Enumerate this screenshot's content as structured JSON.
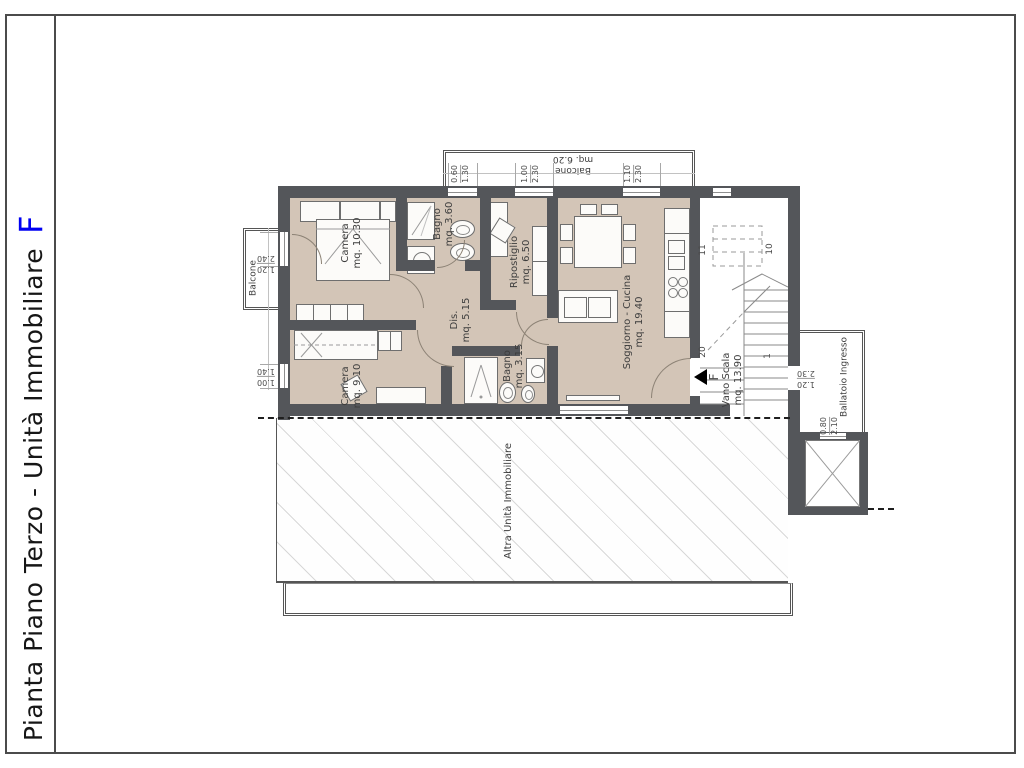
{
  "page": {
    "title_main": "Pianta Piano Terzo - Unità Immobiliare",
    "title_unit": "F"
  },
  "rooms": {
    "camera1": {
      "name": "Camera",
      "area": "mq. 10.30"
    },
    "bagno1": {
      "name": "Bagno",
      "area": "mq. 3.60"
    },
    "ripostiglio": {
      "name": "Ripostiglio",
      "area": "mq. 6.50"
    },
    "soggiorno": {
      "name": "Soggiorno - Cucina",
      "area": "mq. 19.40"
    },
    "dis": {
      "name": "Dis.",
      "area": "mq. 5.15"
    },
    "camera2": {
      "name": "Camera",
      "area": "mq. 9.10"
    },
    "bagno2": {
      "name": "Bagno",
      "area": "mq. 3.15"
    },
    "vano_scala": {
      "name": "Vano Scala",
      "area": "mq. 13.90"
    }
  },
  "outdoor": {
    "balcone_left": "Balcone",
    "balcone_top": {
      "name": "Balcone",
      "area": "mq. 6.20"
    },
    "ballatoio": "Ballatoio Ingresso",
    "altra_unita": "Altra Unità Immobiliare"
  },
  "entrance_marker": "F",
  "stairs": {
    "n_1": "1",
    "n_10": "10",
    "n_11": "11",
    "n_20": "20"
  },
  "dims": {
    "top1": {
      "a": "0.60",
      "b": "1.30"
    },
    "top2": {
      "a": "1.00",
      "b": "2.30"
    },
    "top3": {
      "a": "1.10",
      "b": "2.30"
    },
    "left1": {
      "a": "1.20",
      "b": "2.40"
    },
    "left2": {
      "a": "1.00",
      "b": "1.40"
    },
    "ballatoio_door": {
      "a": "1.20",
      "b": "2.30"
    },
    "elevator_door": {
      "a": "0.80",
      "b": "2.10"
    }
  },
  "colors": {
    "wall": "#54565A",
    "floor": "#D3C5B7",
    "accent_blue": "#0000F2",
    "hatch_line": "#D8D8D8",
    "boundary_dash": "#1F1F1F"
  }
}
